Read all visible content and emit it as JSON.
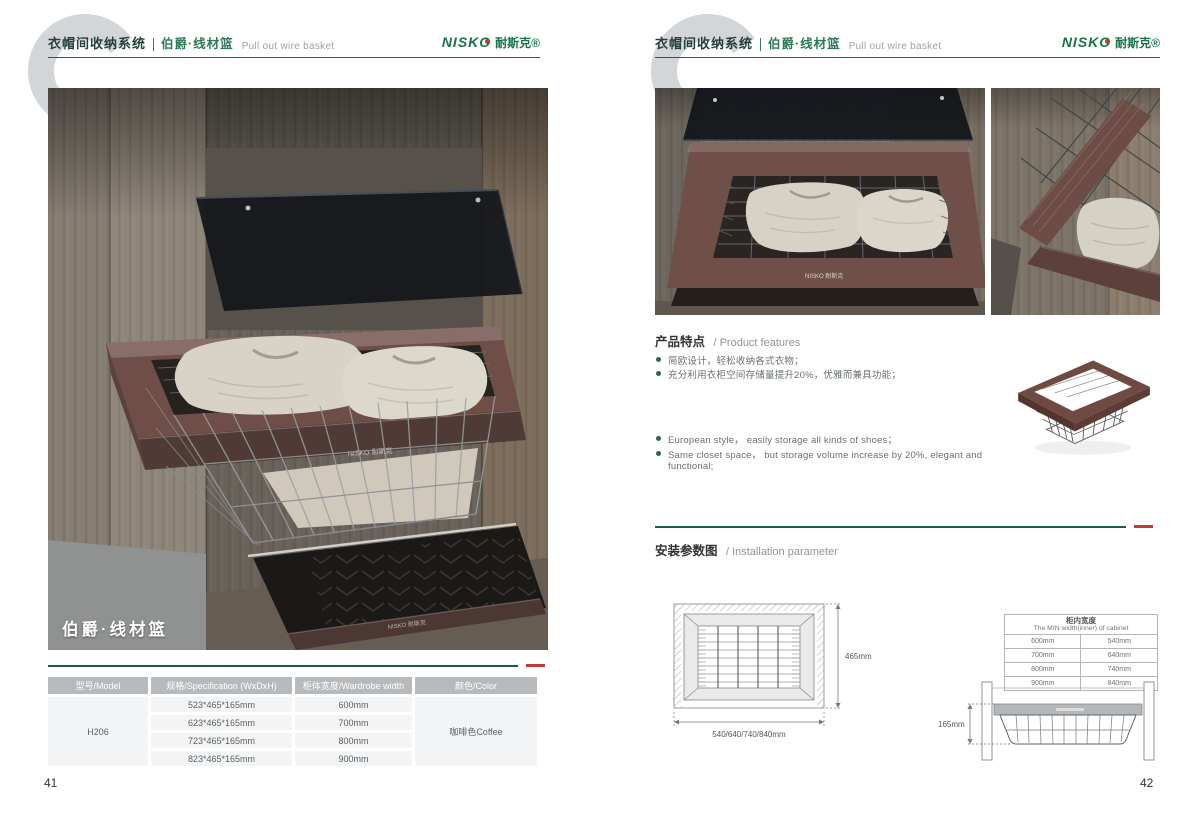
{
  "header": {
    "watermark_letter": "C",
    "category": "衣帽间收纳系统",
    "series": "伯爵·线材篮",
    "subtitle": "Pull out wire basket",
    "brand_en": "NISKO",
    "brand_zh": "耐斯克®",
    "brand_print": "NISKO 耐斯克"
  },
  "left_page": {
    "photo_caption": "伯爵·线材篮",
    "spec_table": {
      "headers": [
        "型号/Model",
        "规格/Specification (WxDxH)",
        "柜体宽度/Wardrobe width",
        "颜色/Color"
      ],
      "model": "H206",
      "color": "咖啡色Coffee",
      "rows": [
        {
          "spec": "523*465*165mm",
          "width": "600mm"
        },
        {
          "spec": "623*465*165mm",
          "width": "700mm"
        },
        {
          "spec": "723*465*165mm",
          "width": "800mm"
        },
        {
          "spec": "823*465*165mm",
          "width": "900mm"
        }
      ]
    },
    "page_number": "41"
  },
  "right_page": {
    "features": {
      "title_zh": "产品特点",
      "title_en": "/ Product features",
      "bullets_zh": [
        "简欧设计，轻松收纳各式衣物；",
        "充分利用衣柜空间存储量提升20%，优雅而兼具功能；"
      ],
      "bullets_en": [
        "European style， easily storage all kinds of shoes；",
        "Same closet space， but storage volume increase by 20%, elegant and functional;"
      ]
    },
    "installation": {
      "title_zh": "安装参数图",
      "title_en": "/ Installation parameter",
      "top_view": {
        "depth_label": "465mm",
        "width_label": "540/640/740/840mm"
      },
      "cabinet_table": {
        "title_zh": "柜内宽度",
        "title_en": "The MIN width(inner) of cabinet",
        "rows": [
          [
            "600mm",
            "540mm"
          ],
          [
            "700mm",
            "640mm"
          ],
          [
            "800mm",
            "740mm"
          ],
          [
            "900mm",
            "840mm"
          ]
        ]
      },
      "front_view": {
        "height_label": "165mm"
      }
    },
    "page_number": "42"
  },
  "colors": {
    "accent_green": "#1d5b46",
    "brand_green": "#157347",
    "accent_red": "#bf3a31",
    "table_header_bg": "#b7babc",
    "frame_coffee": "#6e4e47",
    "watermark_gray": "#d3d6d8"
  }
}
